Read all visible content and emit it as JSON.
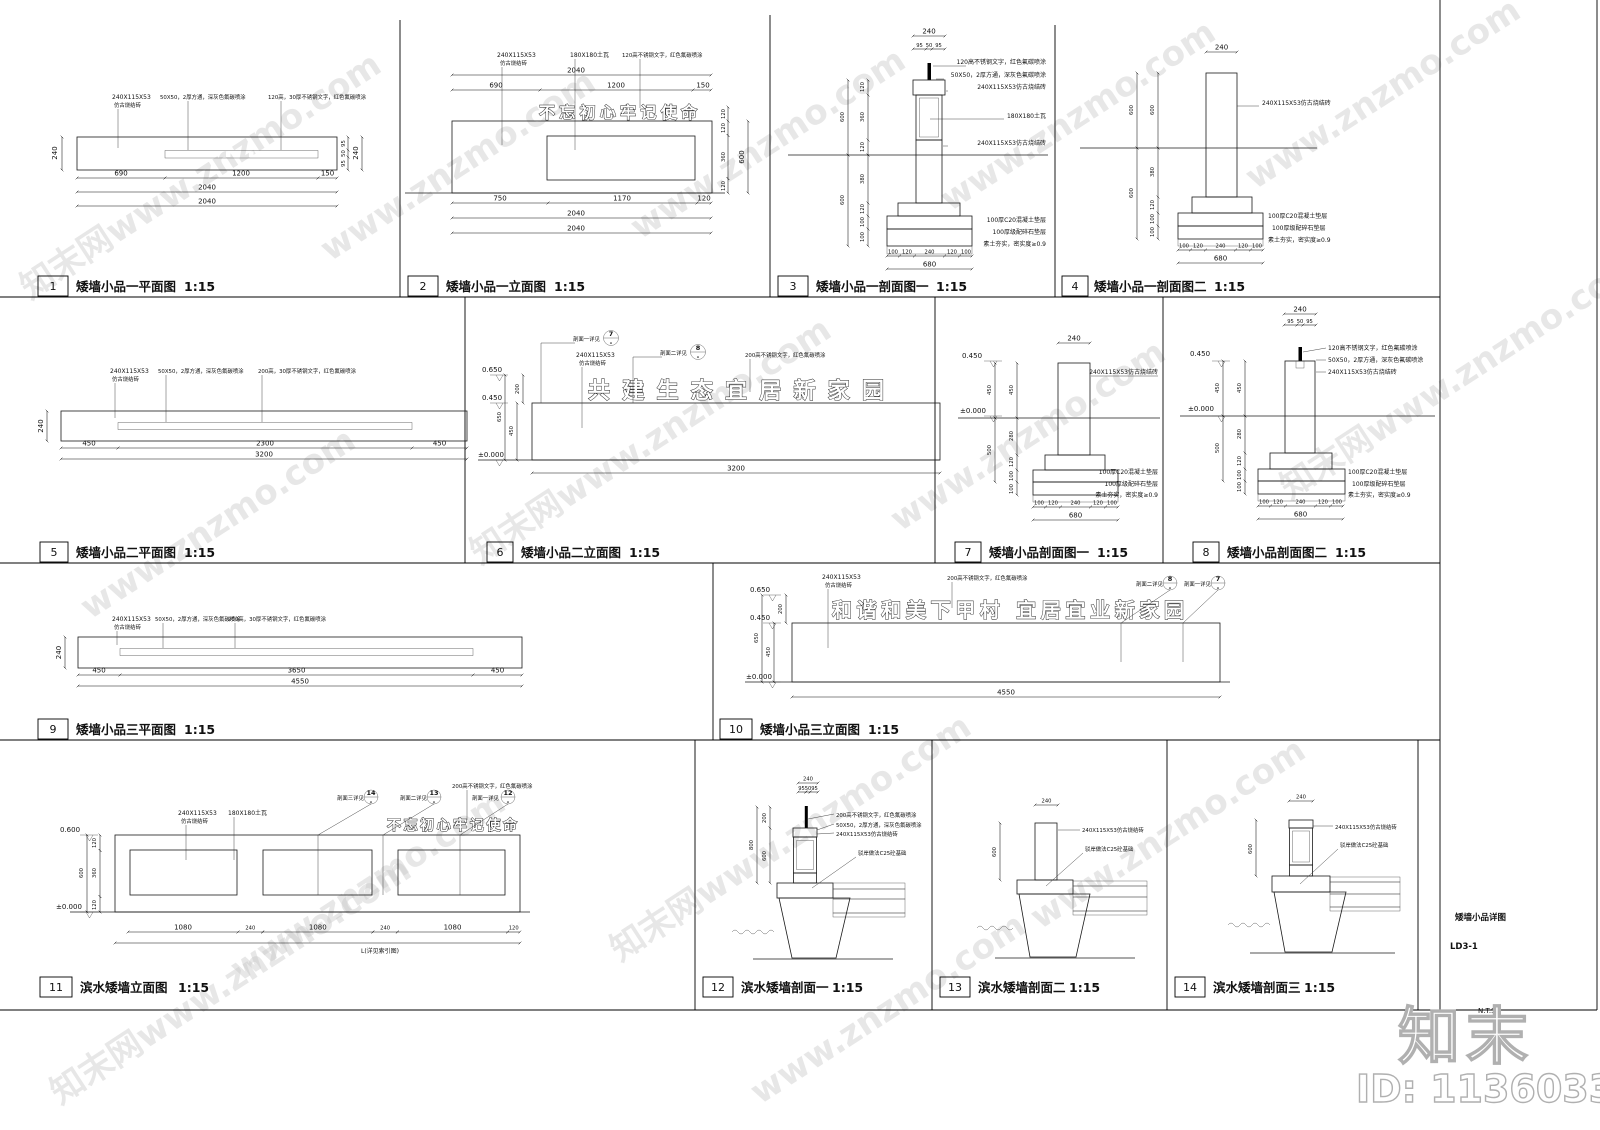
{
  "sheet": {
    "name": "矮墙小品详图",
    "code": "LD3-1",
    "nts": "N.T.S.",
    "logo": "知末",
    "id": "ID: 1136033404"
  },
  "scale": "1:15",
  "wm": {
    "a": "www.znzmo.com",
    "b": "知末网www.znzmo.com"
  },
  "mat": {
    "brick1": "240X115X53",
    "brick2": "仿古烧结砖",
    "brick": "240X115X53仿古烧结砖",
    "steel": "50X50，2厚方通，深灰色氟碳喷涂",
    "sst120": "120高，30厚不锈钢文字，红色氟碳喷涂",
    "sst200": "200高，30厚不锈钢文字，红色氟碳喷涂",
    "sst120s": "120高不锈钢文字，红色氟碳喷涂",
    "sst200s": "200高不锈钢文字，红色氟碳喷涂",
    "tile": "180X180土瓦",
    "c20": "100厚C20混凝土垫层",
    "gravel": "100厚级配碎石垫层",
    "soil": "素土夯实，密实度≥0.9",
    "c25": "驳岸做法C25砼基础"
  },
  "lvl": {
    "a": "0.650",
    "b": "0.450",
    "c": "±0.000",
    "d": "0.600"
  },
  "slogan": {
    "s1": "不忘初心牢记使命",
    "s2": "共建生态宜居新家园",
    "s3": "和谐和美下甲村 宜居宜业新家园"
  },
  "co": {
    "s1": "剖面一详见",
    "s2": "剖面二详见",
    "s3": "剖面三详见",
    "n7": "7",
    "n8": "8",
    "n12": "12",
    "n13": "13",
    "n14": "14",
    "dash": "-"
  },
  "misc": {
    "len": "L(详见索引图)"
  },
  "dim": {
    "50": "50",
    "95": "95",
    "100": "100",
    "120": "120",
    "150": "150",
    "200": "200",
    "240": "240",
    "280": "280",
    "360": "360",
    "380": "380",
    "450": "450",
    "500": "500",
    "600": "600",
    "650": "650",
    "680": "680",
    "690": "690",
    "750": "750",
    "800": "800",
    "1080": "1080",
    "1170": "1170",
    "1200": "1200",
    "2040": "2040",
    "2300": "2300",
    "3200": "3200",
    "3650": "3650",
    "4550": "4550"
  },
  "panels": [
    {
      "no": "1",
      "title": "矮墙小品一平面图"
    },
    {
      "no": "2",
      "title": "矮墙小品一立面图"
    },
    {
      "no": "3",
      "title": "矮墙小品一剖面图一"
    },
    {
      "no": "4",
      "title": "矮墙小品一剖面图二"
    },
    {
      "no": "5",
      "title": "矮墙小品二平面图"
    },
    {
      "no": "6",
      "title": "矮墙小品二立面图"
    },
    {
      "no": "7",
      "title": "矮墙小品剖面图一"
    },
    {
      "no": "8",
      "title": "矮墙小品剖面图二"
    },
    {
      "no": "9",
      "title": "矮墙小品三平面图"
    },
    {
      "no": "10",
      "title": "矮墙小品三立面图"
    },
    {
      "no": "11",
      "title": "滨水矮墙立面图"
    },
    {
      "no": "12",
      "title": "滨水矮墙剖面一"
    },
    {
      "no": "13",
      "title": "滨水矮墙剖面二"
    },
    {
      "no": "14",
      "title": "滨水矮墙剖面三"
    }
  ]
}
